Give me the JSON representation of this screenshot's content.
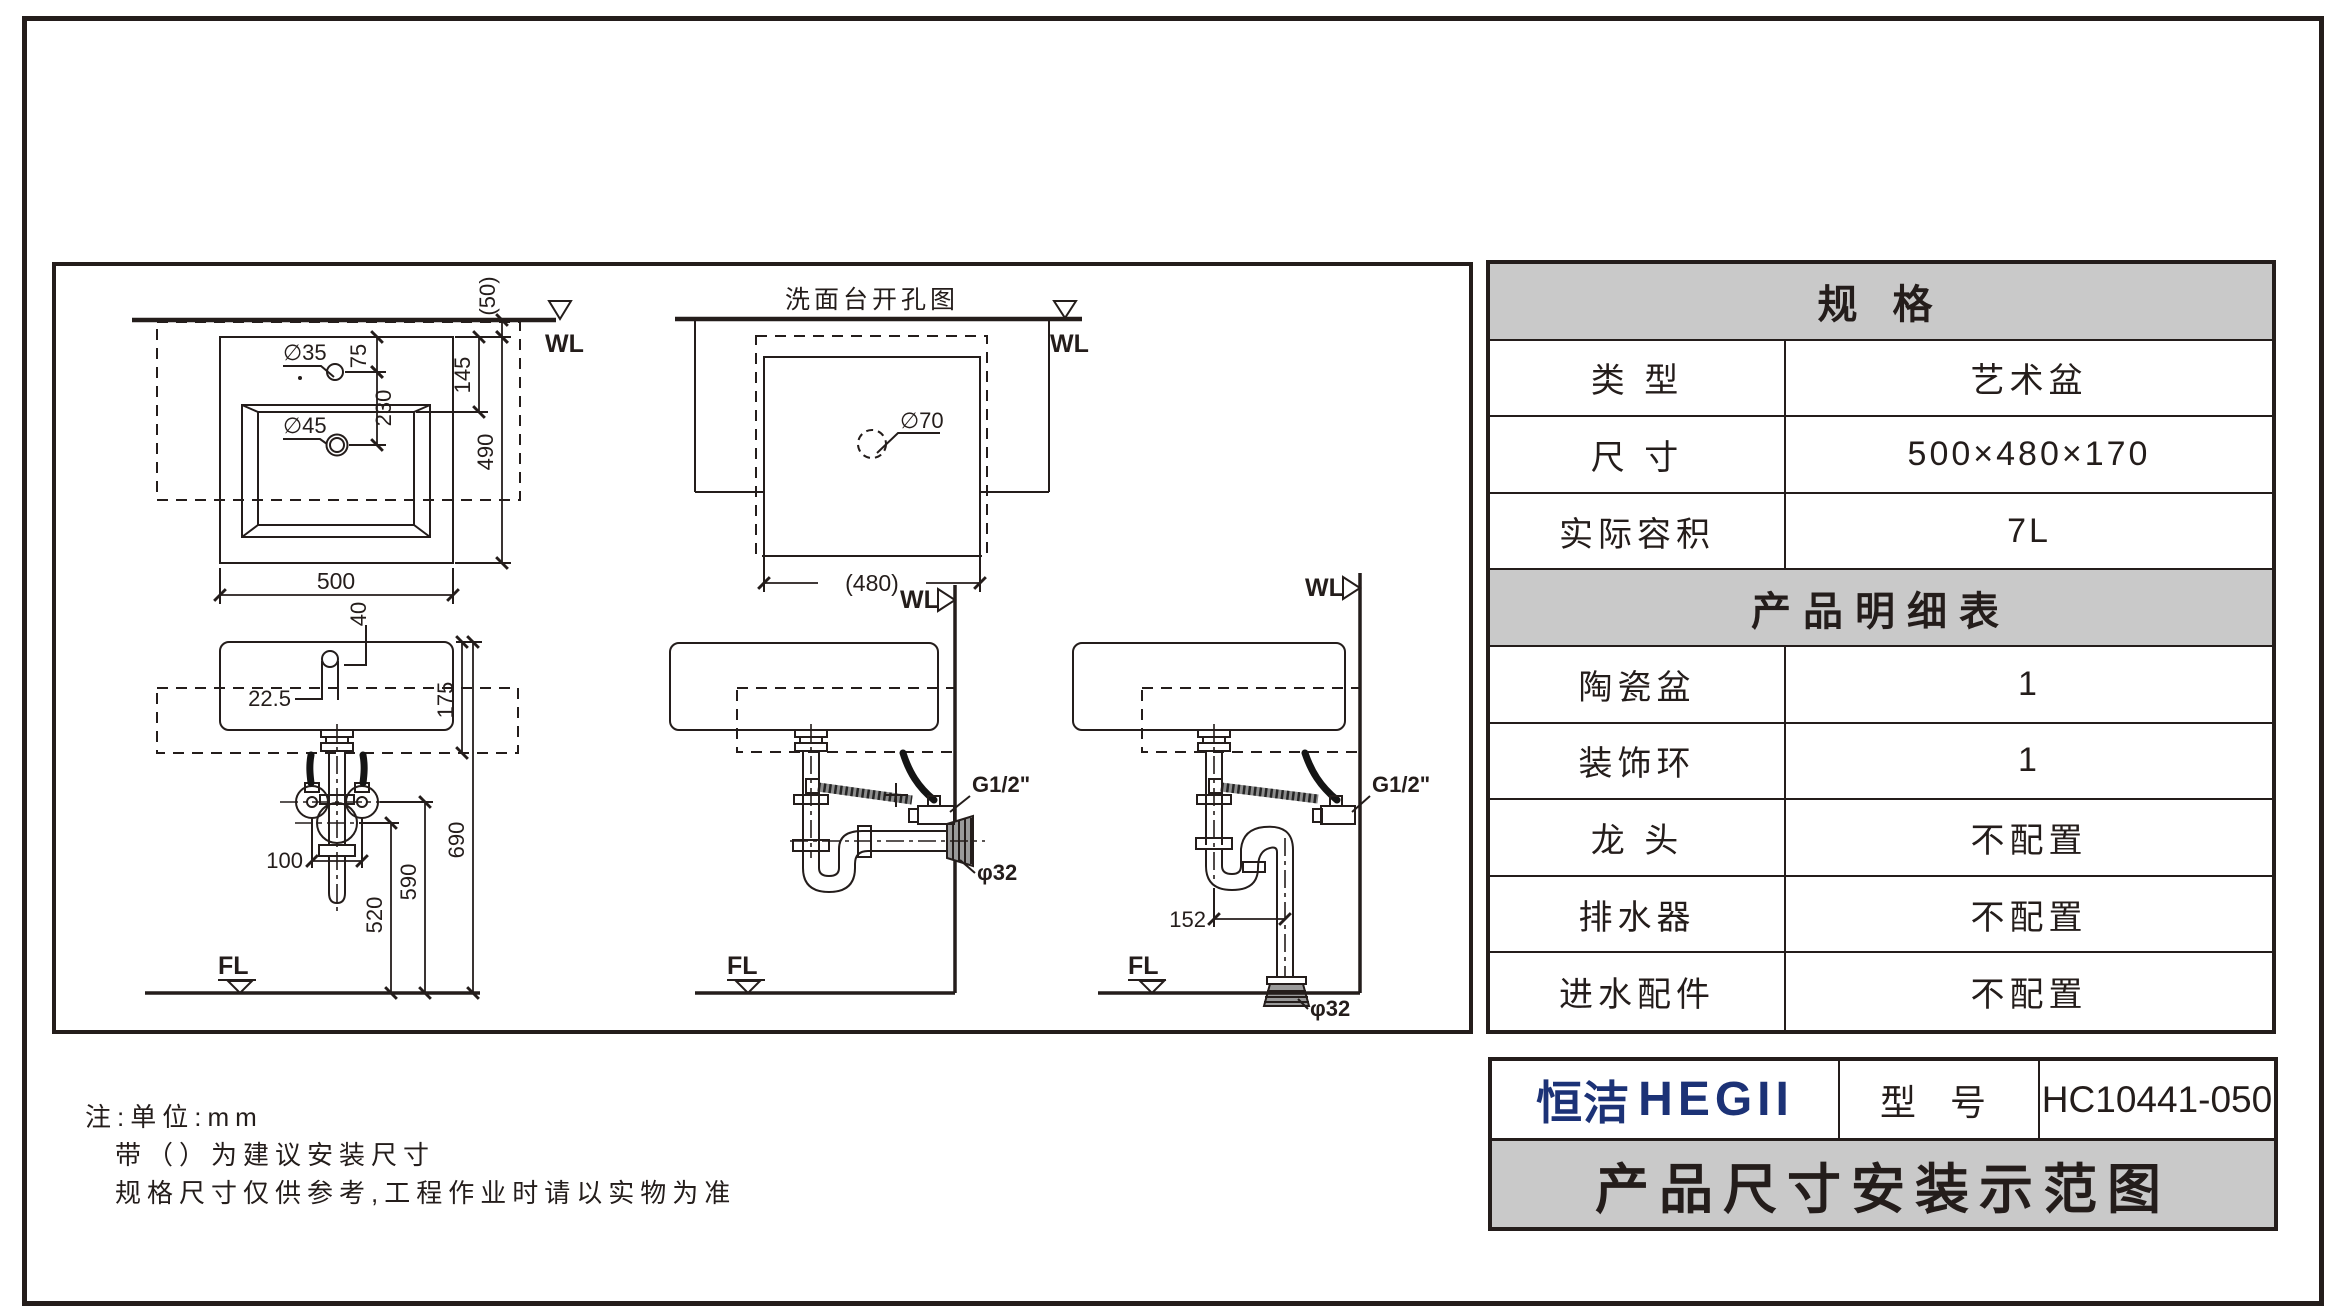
{
  "drawings": {
    "plan": {
      "wl": "WL",
      "dim_50": "(50)",
      "dim_75": "75",
      "dim_145": "145",
      "dim_230": "230",
      "dim_490": "490",
      "dim_500": "500",
      "hole_35": "∅35",
      "hole_45": "∅45"
    },
    "cutout": {
      "title": "洗面台开孔图",
      "wl": "WL",
      "hole_70": "∅70",
      "dim_480": "(480)"
    },
    "front": {
      "dim_40": "40",
      "dim_22_5": "22.5",
      "dim_175": "175",
      "dim_100": "100",
      "dim_520": "520",
      "dim_590": "590",
      "dim_690": "690",
      "fl": "FL"
    },
    "wall_drain": {
      "wl": "WL",
      "g12": "G1/2\"",
      "phi32": "φ32",
      "fl": "FL"
    },
    "floor_drain": {
      "wl": "WL",
      "g12": "G1/2\"",
      "phi32": "φ32",
      "dim_152": "152",
      "fl": "FL"
    }
  },
  "notes": {
    "line1": "注:单位:mm",
    "line2": "带（）为建议安装尺寸",
    "line3": "规格尺寸仅供参考,工程作业时请以实物为准"
  },
  "spec_table": {
    "header": "规 格",
    "rows": [
      {
        "label": "类 型",
        "value": "艺术盆"
      },
      {
        "label": "尺 寸",
        "value": "500×480×170"
      },
      {
        "label": "实际容积",
        "value": "7L"
      }
    ],
    "detail_header": "产品明细表",
    "detail_rows": [
      {
        "label": "陶瓷盆",
        "value": "1"
      },
      {
        "label": "装饰环",
        "value": "1"
      },
      {
        "label": "龙 头",
        "value": "不配置"
      },
      {
        "label": "排水器",
        "value": "不配置"
      },
      {
        "label": "进水配件",
        "value": "不配置"
      }
    ]
  },
  "title_block": {
    "brand_cn": "恒洁",
    "brand_en": "HEGII",
    "model_label": "型 号",
    "model_value": "HC10441-050",
    "doc_title": "产品尺寸安装示范图"
  },
  "colors": {
    "line": "#241d1b",
    "gray_band": "#c9c9c9",
    "brand_blue": "#1c3276"
  }
}
